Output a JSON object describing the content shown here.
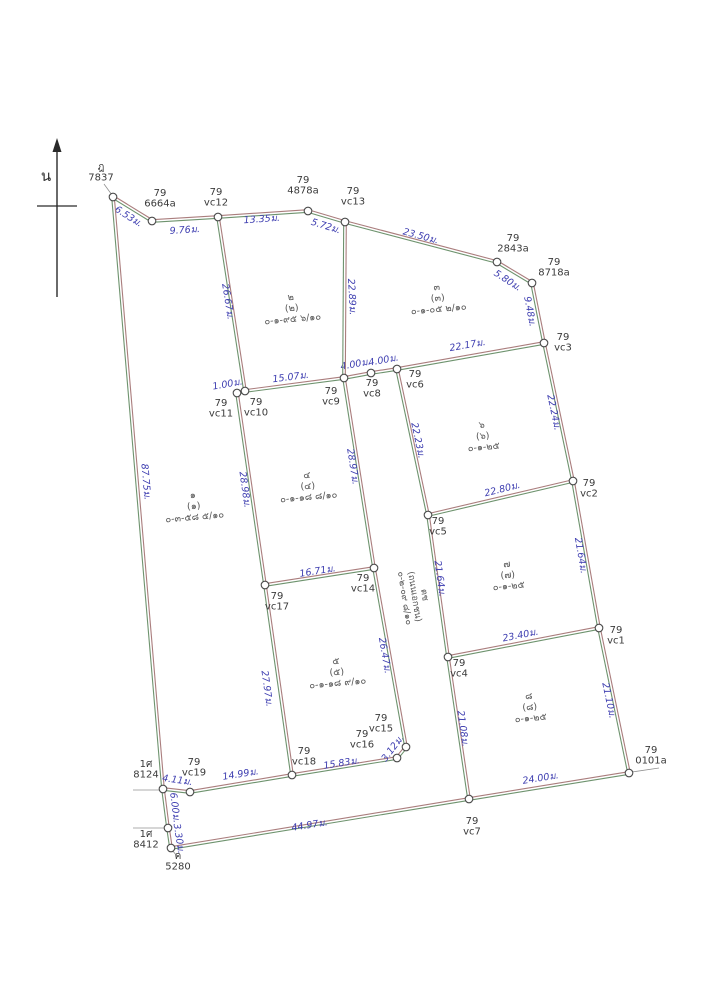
{
  "map": {
    "north": {
      "label": "น",
      "x": 57,
      "tip_y": 138,
      "head_h": 14,
      "base_y": 297,
      "cross_y": 206,
      "cross_x1": 37,
      "cross_x2": 77,
      "label_x": 46,
      "label_y": 181
    },
    "colors": {
      "line_green": "#6e936e",
      "line_red": "#aa7d7d",
      "distance_text": "#3d3db0",
      "label_text": "#3a3a3a",
      "plot_text": "#555555",
      "vertex_fill": "#ffffff",
      "vertex_stroke": "#4a4a4a",
      "leader": "#909090",
      "north": "#2a2a2a"
    },
    "vertices": {
      "7837": [
        113,
        197
      ],
      "6664a": [
        152,
        221
      ],
      "vc12": [
        218,
        217
      ],
      "4878a": [
        308,
        211
      ],
      "vc13": [
        345,
        222
      ],
      "2843a": [
        497,
        262
      ],
      "8718a": [
        532,
        283
      ],
      "vc3": [
        544,
        343
      ],
      "vc2": [
        573,
        481
      ],
      "vc1": [
        599,
        628
      ],
      "0101a": [
        629,
        773
      ],
      "vc7": [
        469,
        799
      ],
      "bl3": [
        171,
        848
      ],
      "bl2": [
        168,
        828
      ],
      "bl1": [
        163,
        789
      ],
      "vc19": [
        190,
        792
      ],
      "vc18": [
        292,
        775
      ],
      "vc16": [
        397,
        758
      ],
      "vc15": [
        406,
        747
      ],
      "vc17": [
        265,
        585
      ],
      "vc14": [
        374,
        568
      ],
      "vc11": [
        237,
        393
      ],
      "vc10": [
        245,
        391
      ],
      "vc9": [
        344,
        378
      ],
      "vc8": [
        371,
        373
      ],
      "vc6": [
        397,
        369
      ],
      "vc5": [
        428,
        515
      ],
      "vc4": [
        448,
        657
      ]
    },
    "edges": [
      {
        "a": "7837",
        "b": "6664a",
        "d": "6.53ม.",
        "x": 127,
        "y": 219,
        "r": 32
      },
      {
        "a": "6664a",
        "b": "vc12",
        "d": "9.76ม.",
        "x": 185,
        "y": 233,
        "r": -4
      },
      {
        "a": "vc12",
        "b": "4878a",
        "d": "13.35ม.",
        "x": 262,
        "y": 222,
        "r": -4
      },
      {
        "a": "4878a",
        "b": "vc13",
        "d": "5.72ม.",
        "x": 325,
        "y": 229,
        "r": 17
      },
      {
        "a": "vc13",
        "b": "2843a",
        "d": "23.50ม.",
        "x": 420,
        "y": 239,
        "r": 15
      },
      {
        "a": "2843a",
        "b": "8718a",
        "d": "5.80ม.",
        "x": 506,
        "y": 283,
        "r": 33
      },
      {
        "a": "8718a",
        "b": "vc3",
        "d": "9.48ม.",
        "x": 527,
        "y": 312,
        "r": 79
      },
      {
        "a": "vc3",
        "b": "vc2",
        "d": "22.24ม.",
        "x": 551,
        "y": 413,
        "r": 78
      },
      {
        "a": "vc2",
        "b": "vc1",
        "d": "21.64ม.",
        "x": 578,
        "y": 556,
        "r": 80
      },
      {
        "a": "vc1",
        "b": "0101a",
        "d": "21.10ม.",
        "x": 606,
        "y": 701,
        "r": 78
      },
      {
        "a": "vc7",
        "b": "0101a",
        "d": "24.00ม.",
        "x": 541,
        "y": 781,
        "r": -9
      },
      {
        "a": "bl3",
        "b": "vc7",
        "d": "44.97ม.",
        "x": 310,
        "y": 828,
        "r": -9
      },
      {
        "a": "bl2",
        "b": "bl3",
        "d": "3.30ม.",
        "x": 176,
        "y": 839,
        "r": 81
      },
      {
        "a": "bl1",
        "b": "bl2",
        "d": "6.00ม.",
        "x": 172,
        "y": 808,
        "r": 83
      },
      {
        "a": "7837",
        "b": "bl1",
        "d": "87.75ม.",
        "x": 143,
        "y": 482,
        "r": 85
      },
      {
        "a": "vc12",
        "b": "vc10",
        "d": "26.67ม.",
        "x": 225,
        "y": 302,
        "r": 81
      },
      {
        "a": "vc11",
        "b": "vc10",
        "d": "1.00ม.",
        "x": 228,
        "y": 387,
        "r": -10
      },
      {
        "a": "vc11",
        "b": "vc17",
        "d": "28.98ม.",
        "x": 242,
        "y": 490,
        "r": 82
      },
      {
        "a": "vc17",
        "b": "vc18",
        "d": "27.97ม.",
        "x": 264,
        "y": 689,
        "r": 82
      },
      {
        "a": "bl1",
        "b": "vc19",
        "d": "4.11ม.",
        "x": 177,
        "y": 783,
        "r": 8
      },
      {
        "a": "vc19",
        "b": "vc18",
        "d": "14.99ม.",
        "x": 241,
        "y": 777,
        "r": -9
      },
      {
        "a": "vc18",
        "b": "vc16",
        "d": "15.83ม.",
        "x": 342,
        "y": 766,
        "r": -9
      },
      {
        "a": "vc16",
        "b": "vc15",
        "d": "3.12ม.",
        "x": 395,
        "y": 750,
        "r": -53
      },
      {
        "a": "vc10",
        "b": "vc9",
        "d": "15.07ม.",
        "x": 291,
        "y": 380,
        "r": -7
      },
      {
        "a": "vc9",
        "b": "vc8",
        "d": "4.00ม.",
        "x": 356,
        "y": 367,
        "r": -10
      },
      {
        "a": "vc8",
        "b": "vc6",
        "d": "4.00ม.",
        "x": 384,
        "y": 363,
        "r": -10
      },
      {
        "a": "vc6",
        "b": "vc3",
        "d": "22.17ม.",
        "x": 468,
        "y": 348,
        "r": -10
      },
      {
        "a": "vc13",
        "b": "vc9",
        "d": "22.89ม.",
        "x": 349,
        "y": 297,
        "r": 87
      },
      {
        "a": "vc9",
        "b": "vc14",
        "d": "28.97ม.",
        "x": 350,
        "y": 467,
        "r": 81
      },
      {
        "a": "vc14",
        "b": "vc15",
        "d": "26.47ม.",
        "x": 382,
        "y": 656,
        "r": 80
      },
      {
        "a": "vc6",
        "b": "vc5",
        "d": "22.23ม.",
        "x": 415,
        "y": 441,
        "r": 78
      },
      {
        "a": "vc5",
        "b": "vc4",
        "d": "21.64ม.",
        "x": 437,
        "y": 579,
        "r": 82
      },
      {
        "a": "vc4",
        "b": "vc7",
        "d": "21.08ม.",
        "x": 460,
        "y": 729,
        "r": 82
      },
      {
        "a": "vc17",
        "b": "vc14",
        "d": "16.71ม.",
        "x": 318,
        "y": 574,
        "r": -9
      },
      {
        "a": "vc5",
        "b": "vc2",
        "d": "22.80ม.",
        "x": 503,
        "y": 492,
        "r": -14
      },
      {
        "a": "vc4",
        "b": "vc1",
        "d": "23.40ม.",
        "x": 521,
        "y": 638,
        "r": -11
      }
    ],
    "vertex_labels": [
      {
        "lines": [
          "79",
          "6664a"
        ],
        "x": 160,
        "y": 196
      },
      {
        "lines": [
          "79",
          "vc12"
        ],
        "x": 216,
        "y": 195
      },
      {
        "lines": [
          "79",
          "4878a"
        ],
        "x": 303,
        "y": 183
      },
      {
        "lines": [
          "79",
          "vc13"
        ],
        "x": 353,
        "y": 194
      },
      {
        "lines": [
          "79",
          "2843a"
        ],
        "x": 513,
        "y": 241
      },
      {
        "lines": [
          "79",
          "8718a"
        ],
        "x": 554,
        "y": 265
      },
      {
        "lines": [
          "79",
          "vc3"
        ],
        "x": 563,
        "y": 340
      },
      {
        "lines": [
          "79",
          "vc2"
        ],
        "x": 589,
        "y": 486
      },
      {
        "lines": [
          "79",
          "vc1"
        ],
        "x": 616,
        "y": 633
      },
      {
        "lines": [
          "79",
          "0101a"
        ],
        "x": 651,
        "y": 753
      },
      {
        "lines": [
          "79",
          "vc7"
        ],
        "x": 472,
        "y": 824
      },
      {
        "lines": [
          "79",
          "vc6"
        ],
        "x": 415,
        "y": 377
      },
      {
        "lines": [
          "79",
          "vc8"
        ],
        "x": 372,
        "y": 386
      },
      {
        "lines": [
          "79",
          "vc9"
        ],
        "x": 331,
        "y": 394
      },
      {
        "lines": [
          "79",
          "vc10"
        ],
        "x": 256,
        "y": 405
      },
      {
        "lines": [
          "79",
          "vc11"
        ],
        "x": 221,
        "y": 406
      },
      {
        "lines": [
          "79",
          "vc5"
        ],
        "x": 438,
        "y": 524
      },
      {
        "lines": [
          "79",
          "vc4"
        ],
        "x": 459,
        "y": 666
      },
      {
        "lines": [
          "79",
          "vc17"
        ],
        "x": 277,
        "y": 599
      },
      {
        "lines": [
          "79",
          "vc14"
        ],
        "x": 363,
        "y": 581
      },
      {
        "lines": [
          "79",
          "vc19"
        ],
        "x": 194,
        "y": 765
      },
      {
        "lines": [
          "79",
          "vc18"
        ],
        "x": 304,
        "y": 754
      },
      {
        "lines": [
          "79",
          "vc16"
        ],
        "x": 362,
        "y": 737
      },
      {
        "lines": [
          "79",
          "vc15"
        ],
        "x": 381,
        "y": 721
      }
    ],
    "plots": [
      {
        "lines": [
          "๑",
          "(๑)",
          "๐-๓-๕๘ ๕/๑๐"
        ],
        "x": 194,
        "y": 509,
        "rot": -5
      },
      {
        "lines": [
          "๒",
          "(๒)",
          "๐-๑-๙๕ ๖/๑๐"
        ],
        "x": 292,
        "y": 311,
        "rot": -5
      },
      {
        "lines": [
          "๓",
          "(๓)",
          "๐-๑-๐๕ ๒/๑๐"
        ],
        "x": 438,
        "y": 301,
        "rot": -5
      },
      {
        "lines": [
          "๔",
          "(๔)",
          "๐-๑-๑๘ ๘/๑๐"
        ],
        "x": 308,
        "y": 489,
        "rot": -5
      },
      {
        "lines": [
          "๕",
          "(๕)",
          "๐-๑-๑๘ ๙/๑๐"
        ],
        "x": 337,
        "y": 675,
        "rot": -5
      },
      {
        "lines": [
          "๖",
          "(๖)",
          "๐-๑-๒๕"
        ],
        "x": 483,
        "y": 439,
        "rot": -5
      },
      {
        "lines": [
          "๗",
          "(๗)",
          "๐-๑-๒๕"
        ],
        "x": 508,
        "y": 578,
        "rot": -5
      },
      {
        "lines": [
          "๘",
          "(๘)",
          "๐-๑-๒๕"
        ],
        "x": 530,
        "y": 710,
        "rot": -5
      }
    ],
    "road_label": {
      "lines": [
        "ตช",
        "(ถนนเอกชน)",
        "๐-๒-๐๙ ๘/๑๐"
      ],
      "x": 412,
      "y": 597,
      "rot": 81
    },
    "neighbors": [
      {
        "lines": [
          "ฎ",
          "7837"
        ],
        "x": 101,
        "y": 170,
        "leader": [
          104,
          184,
          112,
          195
        ]
      },
      {
        "lines": [
          "1ศ",
          "8124"
        ],
        "x": 146,
        "y": 767,
        "leader": [
          133,
          790,
          160,
          790
        ]
      },
      {
        "lines": [
          "1ศ",
          "8412"
        ],
        "x": 146,
        "y": 837,
        "leader": [
          133,
          828,
          165,
          828
        ]
      },
      {
        "lines": [
          "ค",
          "5280"
        ],
        "x": 178,
        "y": 859,
        "leader": [
          172,
          850,
          177,
          856
        ]
      }
    ],
    "extra_leaders": [
      [
        632,
        772,
        659,
        768
      ]
    ]
  }
}
